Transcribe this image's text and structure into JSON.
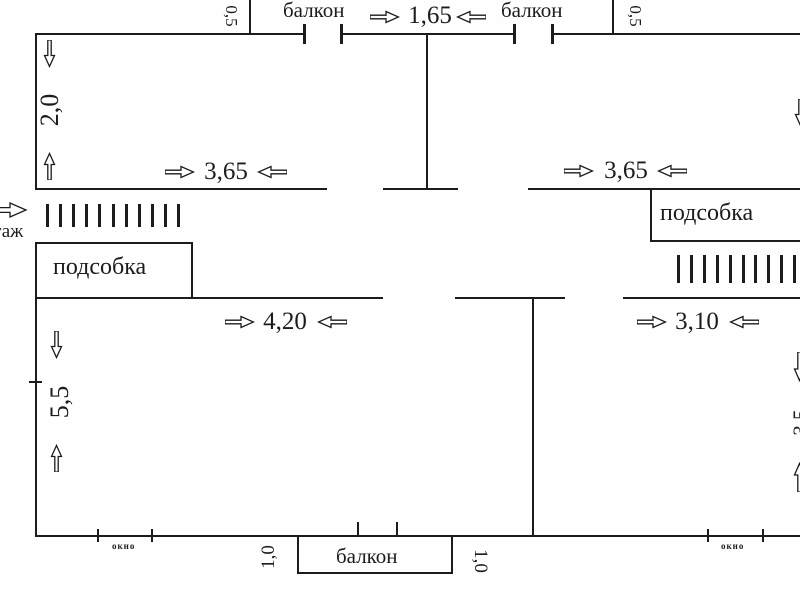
{
  "plan": {
    "type": "apartment-floor-plan",
    "colors": {
      "line": "#1c1c1c",
      "background": "#fefefe"
    },
    "balconies": {
      "top_left_label": "балкон",
      "top_right_label": "балкон",
      "bottom_label": "балкон",
      "gap_width": "1,65",
      "depth_left": "0,5",
      "depth_right": "0,5",
      "bottom_offset_left": "1,0",
      "bottom_offset_right": "1,0"
    },
    "rooms": {
      "top_left": {
        "width": "3,65",
        "height": "2,0"
      },
      "top_right": {
        "width": "3,65"
      },
      "bottom_left": {
        "width": "4,20",
        "height": "5,5"
      },
      "bottom_right": {
        "width": "3,10",
        "height": "3,5"
      }
    },
    "utility": {
      "left_label": "подсобка",
      "right_label": "подсобка"
    },
    "entrance": {
      "floor_label": "этаж"
    },
    "windows": {
      "left_label": "окно",
      "right_label": "окно"
    }
  }
}
